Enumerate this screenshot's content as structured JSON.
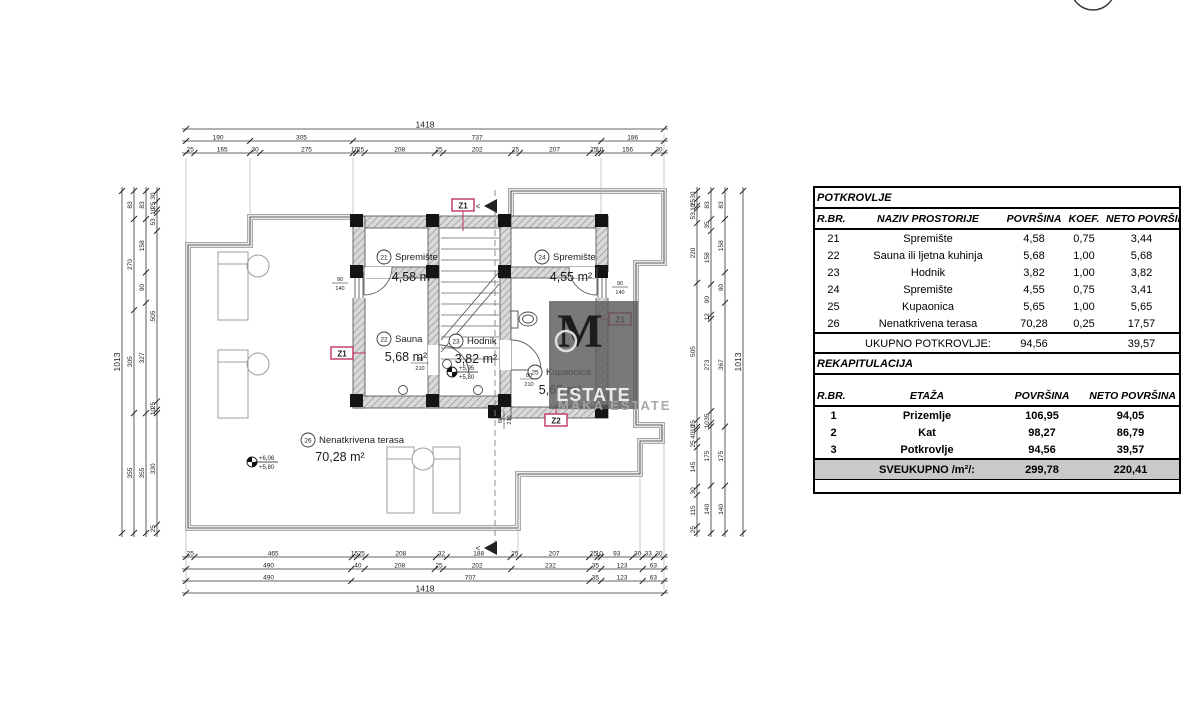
{
  "plan": {
    "rooms": [
      {
        "num": "21",
        "name": "Spremište",
        "area": "4,58 m²"
      },
      {
        "num": "22",
        "name": "Sauna",
        "area": "5,68 m²"
      },
      {
        "num": "23",
        "name": "Hodnik",
        "area": "3,82 m²"
      },
      {
        "num": "24",
        "name": "Spremište",
        "area": "4,55 m²"
      },
      {
        "num": "25",
        "name": "Kupaonica",
        "area": "5,65 m²"
      },
      {
        "num": "26",
        "name": "Nenatkrivena terasa",
        "area": "70,28 m²"
      }
    ],
    "markers": [
      "Z1",
      "Z1",
      "Z1",
      "Z2"
    ],
    "levels": [
      {
        "top": "+5,95",
        "bottom": "+5,80"
      },
      {
        "top": "+6,06",
        "bottom": "+5,80"
      }
    ],
    "openings": [
      {
        "w": "80",
        "h": "210"
      },
      {
        "w": "80",
        "h": "210"
      },
      {
        "w": "80",
        "h": "210"
      },
      {
        "w": "90",
        "h": "140"
      },
      {
        "w": "90",
        "h": "140"
      }
    ],
    "section_arrow_glyph": "<",
    "colors": {
      "marker": "#c13366",
      "wall_line": "#4a4a4a",
      "hatch": "#8f8f8f"
    }
  },
  "dims": {
    "top_rows": [
      [
        "1418"
      ],
      [
        "190",
        "305",
        "737",
        "186"
      ],
      [
        "25",
        "165",
        "30",
        "275",
        "10",
        "25",
        "208",
        "25",
        "202",
        "25",
        "207",
        "25",
        "10",
        "156",
        "30"
      ]
    ],
    "bottom_rows": [
      [
        "25",
        "465",
        "15",
        "25",
        "208",
        "32",
        "188",
        "25",
        "207",
        "25",
        "10",
        "93",
        "30",
        "33",
        "30"
      ],
      [
        "490",
        "40",
        "208",
        "25",
        "202",
        "232",
        "35",
        "123",
        "63"
      ],
      [
        "490",
        "707",
        "35",
        "123",
        "63"
      ],
      [
        "1418"
      ]
    ],
    "left_cols": [
      [
        "1013"
      ],
      [
        "83",
        "270",
        "305",
        "355"
      ],
      [
        "83",
        "158",
        "90",
        "327",
        "355"
      ],
      [
        "30",
        "25",
        "10",
        "53",
        "505",
        "25",
        "10",
        "330",
        "25"
      ]
    ],
    "right_cols": [
      [
        "30",
        "25",
        "10",
        "53",
        "220",
        "505",
        "25",
        "10",
        "40",
        "25",
        "145",
        "30",
        "115",
        "25"
      ],
      [
        "83",
        "35",
        "158",
        "90",
        "12",
        "273",
        "35",
        "10",
        "175",
        "140"
      ],
      [
        "83",
        "158",
        "90",
        "367",
        "175",
        "140"
      ],
      [
        "1013"
      ]
    ]
  },
  "watermark": {
    "monogram": "M",
    "line1": "ESTATE",
    "line2": "MAKA ESTATE"
  },
  "tables": {
    "potkrovlje": {
      "title": "POTKROVLJE",
      "headers": [
        "R.BR.",
        "NAZIV PROSTORIJE",
        "POVRŠINA",
        "KOEF.",
        "NETO POVRŠINA"
      ],
      "rows": [
        [
          "21",
          "Spremište",
          "4,58",
          "0,75",
          "3,44"
        ],
        [
          "22",
          "Sauna ili ljetna kuhinja",
          "5,68",
          "1,00",
          "5,68"
        ],
        [
          "23",
          "Hodnik",
          "3,82",
          "1,00",
          "3,82"
        ],
        [
          "24",
          "Spremište",
          "4,55",
          "0,75",
          "3,41"
        ],
        [
          "25",
          "Kupaonica",
          "5,65",
          "1,00",
          "5,65"
        ],
        [
          "26",
          "Nenatkrivena terasa",
          "70,28",
          "0,25",
          "17,57"
        ]
      ],
      "total": {
        "label": "UKUPNO POTKROVLJE:",
        "povrsina": "94,56",
        "neto": "39,57"
      }
    },
    "rekapitulacija": {
      "title": "REKAPITULACIJA",
      "headers": [
        "R.BR.",
        "ETAŽA",
        "POVRŠINA",
        "NETO POVRŠINA"
      ],
      "rows": [
        [
          "1",
          "Prizemlje",
          "106,95",
          "94,05"
        ],
        [
          "2",
          "Kat",
          "98,27",
          "86,79"
        ],
        [
          "3",
          "Potkrovlje",
          "94,56",
          "39,57"
        ]
      ],
      "total": {
        "label": "SVEUKUPNO /m²/:",
        "povrsina": "299,78",
        "neto": "220,41"
      }
    }
  }
}
